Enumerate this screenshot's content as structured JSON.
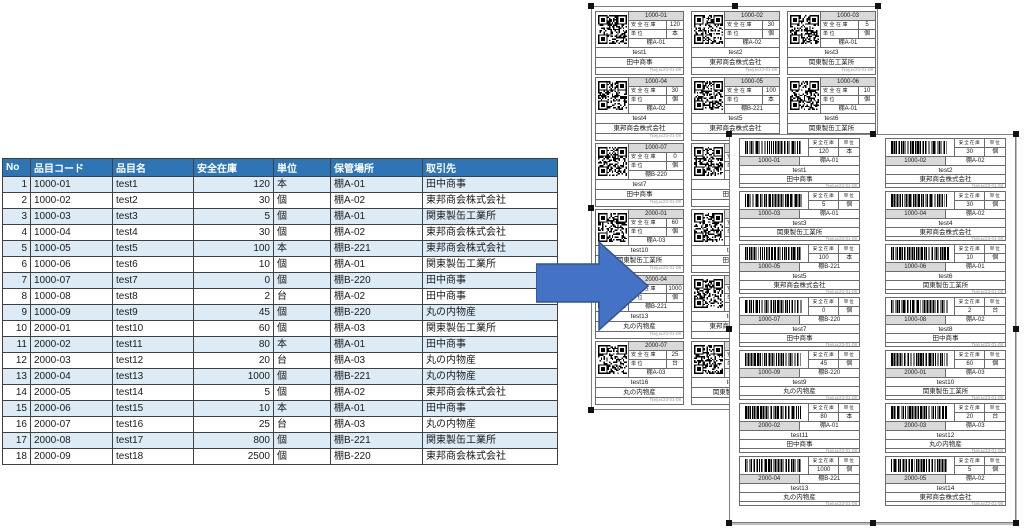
{
  "table": {
    "headers": [
      "No",
      "品目コード",
      "品目名",
      "安全在庫",
      "単位",
      "保管場所",
      "取引先"
    ]
  },
  "items": [
    {
      "no": 1,
      "code": "1000-01",
      "name": "test1",
      "stock": "120",
      "unit": "本",
      "location": "棚A-01",
      "supplier": "田中商事"
    },
    {
      "no": 2,
      "code": "1000-02",
      "name": "test2",
      "stock": "30",
      "unit": "個",
      "location": "棚A-02",
      "supplier": "東邦商会株式会社"
    },
    {
      "no": 3,
      "code": "1000-03",
      "name": "test3",
      "stock": "5",
      "unit": "個",
      "location": "棚A-01",
      "supplier": "関東製缶工業所"
    },
    {
      "no": 4,
      "code": "1000-04",
      "name": "test4",
      "stock": "30",
      "unit": "個",
      "location": "棚A-02",
      "supplier": "東邦商会株式会社"
    },
    {
      "no": 5,
      "code": "1000-05",
      "name": "test5",
      "stock": "100",
      "unit": "本",
      "location": "棚B-221",
      "supplier": "東邦商会株式会社"
    },
    {
      "no": 6,
      "code": "1000-06",
      "name": "test6",
      "stock": "10",
      "unit": "個",
      "location": "棚A-01",
      "supplier": "関東製缶工業所"
    },
    {
      "no": 7,
      "code": "1000-07",
      "name": "test7",
      "stock": "0",
      "unit": "個",
      "location": "棚B-220",
      "supplier": "田中商事"
    },
    {
      "no": 8,
      "code": "1000-08",
      "name": "test8",
      "stock": "2",
      "unit": "台",
      "location": "棚A-02",
      "supplier": "田中商事"
    },
    {
      "no": 9,
      "code": "1000-09",
      "name": "test9",
      "stock": "45",
      "unit": "個",
      "location": "棚B-220",
      "supplier": "丸の内物産"
    },
    {
      "no": 10,
      "code": "2000-01",
      "name": "test10",
      "stock": "60",
      "unit": "個",
      "location": "棚A-03",
      "supplier": "関東製缶工業所"
    },
    {
      "no": 11,
      "code": "2000-02",
      "name": "test11",
      "stock": "80",
      "unit": "本",
      "location": "棚A-01",
      "supplier": "田中商事"
    },
    {
      "no": 12,
      "code": "2000-03",
      "name": "test12",
      "stock": "20",
      "unit": "台",
      "location": "棚A-03",
      "supplier": "丸の内物産"
    },
    {
      "no": 13,
      "code": "2000-04",
      "name": "test13",
      "stock": "1000",
      "unit": "個",
      "location": "棚B-221",
      "supplier": "丸の内物産"
    },
    {
      "no": 14,
      "code": "2000-05",
      "name": "test14",
      "stock": "5",
      "unit": "個",
      "location": "棚A-02",
      "supplier": "東邦商会株式会社"
    },
    {
      "no": 15,
      "code": "2000-06",
      "name": "test15",
      "stock": "10",
      "unit": "本",
      "location": "棚A-01",
      "supplier": "田中商事"
    },
    {
      "no": 16,
      "code": "2000-07",
      "name": "test16",
      "stock": "25",
      "unit": "台",
      "location": "棚A-03",
      "supplier": "丸の内物産"
    },
    {
      "no": 17,
      "code": "2000-08",
      "name": "test17",
      "stock": "800",
      "unit": "個",
      "location": "棚B-221",
      "supplier": "関東製缶工業所"
    },
    {
      "no": 18,
      "code": "2000-09",
      "name": "test18",
      "stock": "2500",
      "unit": "個",
      "location": "棚B-220",
      "supplier": "東邦商会株式会社"
    }
  ],
  "sticker_labels": {
    "safety_stock": "安全在庫",
    "unit": "単位",
    "footer_note": "作成日23-01-08"
  },
  "qr_sheet": {
    "labels_count": 18,
    "columns": 3
  },
  "barcode_sheet": {
    "labels_count": 14,
    "columns": 2
  },
  "colors": {
    "header_bg": "#2E75B6",
    "row_alt": "#DDEBF7",
    "arrow_fill": "#4472C4",
    "arrow_stroke": "#2F5597",
    "cell_gray": "#D9D9D9"
  }
}
